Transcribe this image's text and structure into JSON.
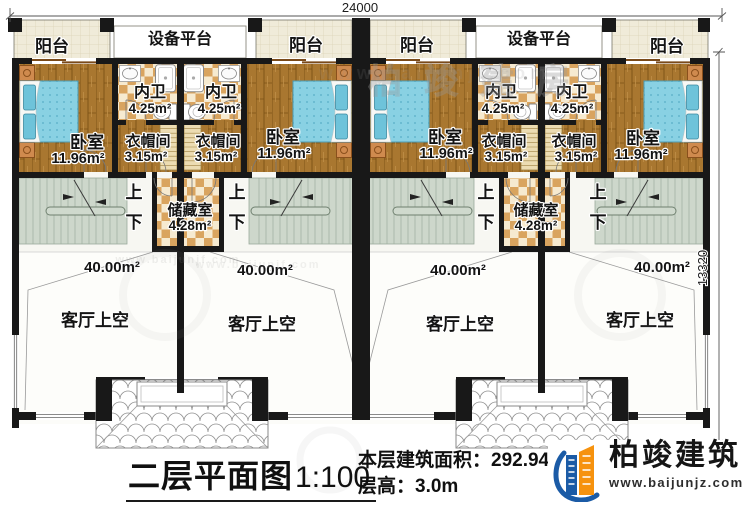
{
  "dimensions": {
    "top": "24000",
    "right": "13320"
  },
  "labels": {
    "balcony": "阳台",
    "equipment_platform": "设备平台",
    "inner_bath": "内卫",
    "inner_bath_area": "4.25m²",
    "bedroom": "卧室",
    "bedroom_area": "11.96m²",
    "cloakroom": "衣帽间",
    "cloakroom_area": "3.15m²",
    "storage": "储藏室",
    "storage_area": "4.28m²",
    "up": "上",
    "down": "下",
    "living_void": "客厅上空",
    "living_void_area": "40.00m²"
  },
  "title_block": {
    "plan_title": "二层平面图",
    "scale": "1:100",
    "area_line": "本层建筑面积：292.94㎡",
    "floor_height_line": "层高：3.0m"
  },
  "logo": {
    "brand": "柏竣建筑",
    "website": "www.baijunjz.com"
  },
  "watermark": {
    "site": "www.baijunjf.com",
    "brand": "柏竣建房"
  },
  "colors": {
    "wall": "#181818",
    "wood": "#a97730",
    "checker_dark": "#d9a45f",
    "checker_light": "#f6ead0",
    "balcony_tile": "#f0ebd9",
    "stair": "#cdd7cb",
    "bed_blue": "#89d1e3",
    "logo_blue": "#1b5ba6",
    "logo_orange": "#f6920e"
  }
}
